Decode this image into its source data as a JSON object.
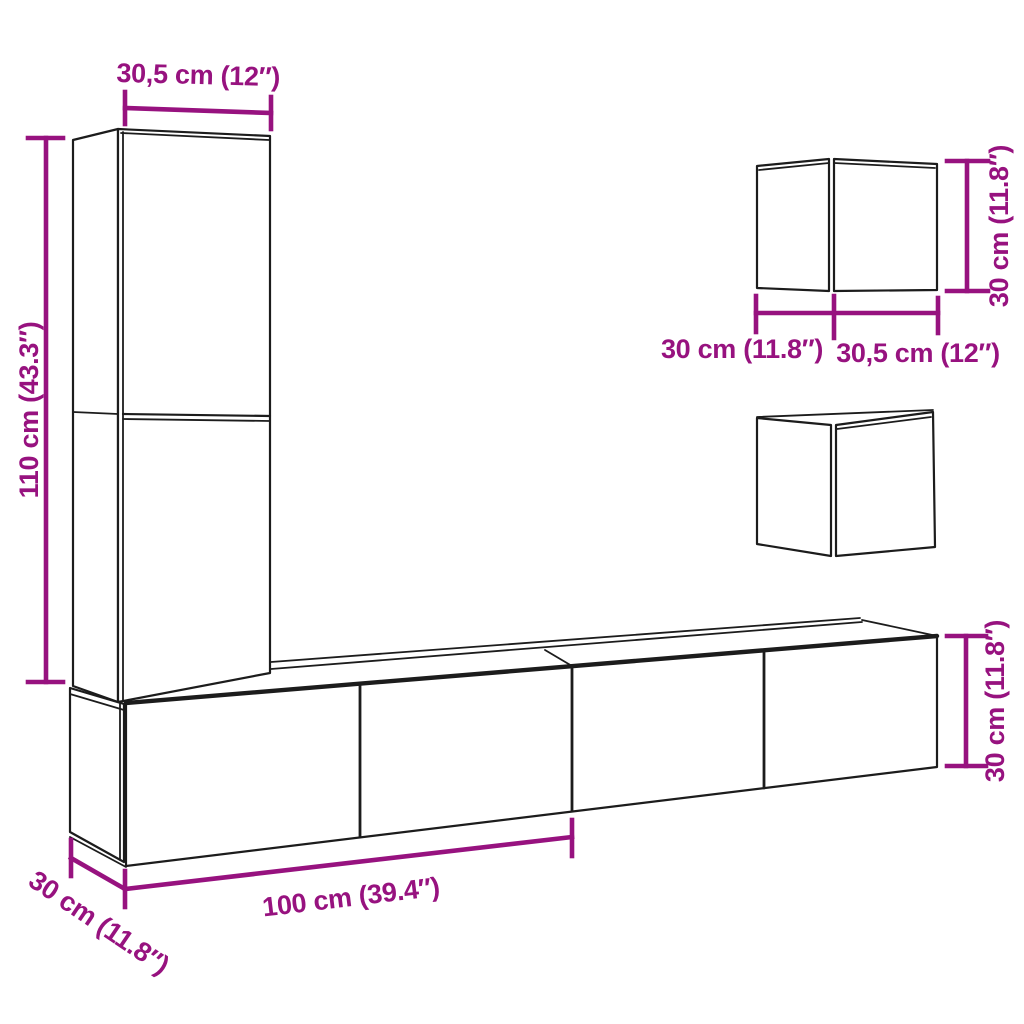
{
  "figure": {
    "kind": "product dimension diagram",
    "subject": "wall-mounted TV furniture set (tall cabinet, two wall cubes, TV bench)"
  },
  "colors": {
    "dimension": "#97127f",
    "line": "#1c1c1c",
    "background": "#ffffff"
  },
  "labels": {
    "tall_cabinet_width": "30,5 cm (12″)",
    "tall_cabinet_height": "110 cm (43.3″)",
    "top_cube_depth": "30 cm (11.8″)",
    "top_cube_width": "30,5 cm (12″)",
    "top_cube_height": "30 cm (11.8″)",
    "bench_width": "100 cm (39.4″)",
    "bench_depth": "30 cm (11.8″)",
    "bench_height": "30 cm (11.8″)"
  }
}
